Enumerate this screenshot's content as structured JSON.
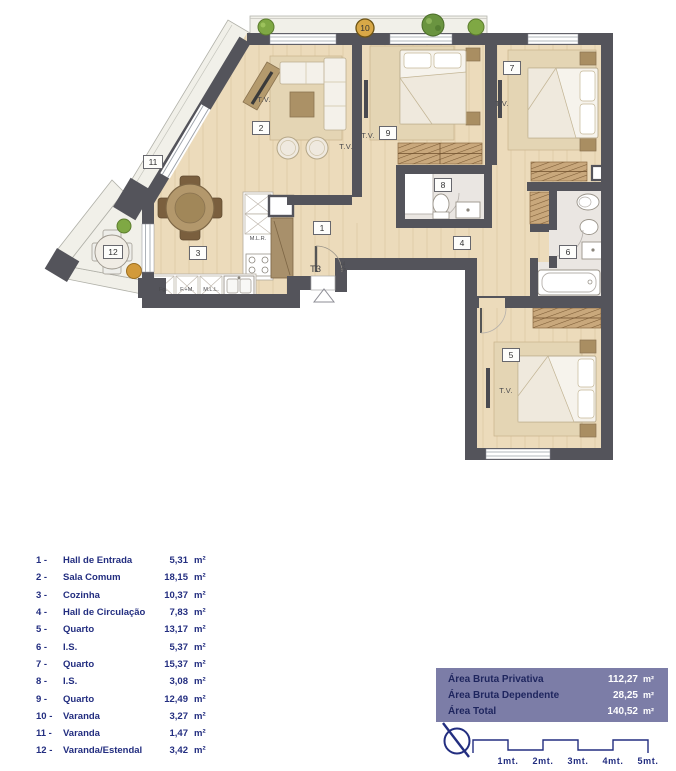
{
  "plan": {
    "room_numbers": [
      "1",
      "2",
      "3",
      "4",
      "5",
      "6",
      "7",
      "8",
      "9",
      "10",
      "11",
      "12"
    ],
    "annotations": {
      "tv": "T.V.",
      "t3": "T3",
      "qe": "Q.E.",
      "mlr": "M.L.R.",
      "fg": "Fg.",
      "fm": "F.+M.",
      "mll": "M.L.L."
    }
  },
  "legend": {
    "items": [
      {
        "num": "1 -",
        "name": "Hall de Entrada",
        "area": "5,31",
        "unit": "m²"
      },
      {
        "num": "2 -",
        "name": "Sala Comum",
        "area": "18,15",
        "unit": "m²"
      },
      {
        "num": "3 -",
        "name": "Cozinha",
        "area": "10,37",
        "unit": "m²"
      },
      {
        "num": "4 -",
        "name": "Hall de Circulação",
        "area": "7,83",
        "unit": "m²"
      },
      {
        "num": "5 -",
        "name": "Quarto",
        "area": "13,17",
        "unit": "m²"
      },
      {
        "num": "6 -",
        "name": "I.S.",
        "area": "5,37",
        "unit": "m²"
      },
      {
        "num": "7 -",
        "name": "Quarto",
        "area": "15,37",
        "unit": "m²"
      },
      {
        "num": "8 -",
        "name": "I.S.",
        "area": "3,08",
        "unit": "m²"
      },
      {
        "num": "9 -",
        "name": "Quarto",
        "area": "12,49",
        "unit": "m²"
      },
      {
        "num": "10 -",
        "name": "Varanda",
        "area": "3,27",
        "unit": "m²"
      },
      {
        "num": "11 -",
        "name": "Varanda",
        "area": "1,47",
        "unit": "m²"
      },
      {
        "num": "12 -",
        "name": "Varanda/Estendal",
        "area": "3,42",
        "unit": "m²"
      }
    ]
  },
  "summary": {
    "rows": [
      {
        "label": "Área Bruta Privativa",
        "value": "112,27",
        "unit": "m²"
      },
      {
        "label": "Área Bruta Dependente",
        "value": "28,25",
        "unit": "m²"
      },
      {
        "label": "Área Total",
        "value": "140,52",
        "unit": "m²"
      }
    ]
  },
  "scale": {
    "labels": [
      "1mt.",
      "2mt.",
      "3mt.",
      "4mt.",
      "5mt."
    ]
  },
  "colors": {
    "wall": "#54545b",
    "wood_floor": "#ecdbbb",
    "balcony_floor": "#f1f0e9",
    "marble_floor": "#eae6e2",
    "navy_text": "#232e80",
    "panel_bg": "#7c7da7",
    "panel_label": "#1e255e",
    "badge_amber": "#d8a847",
    "plant_green": "#7fa844"
  }
}
